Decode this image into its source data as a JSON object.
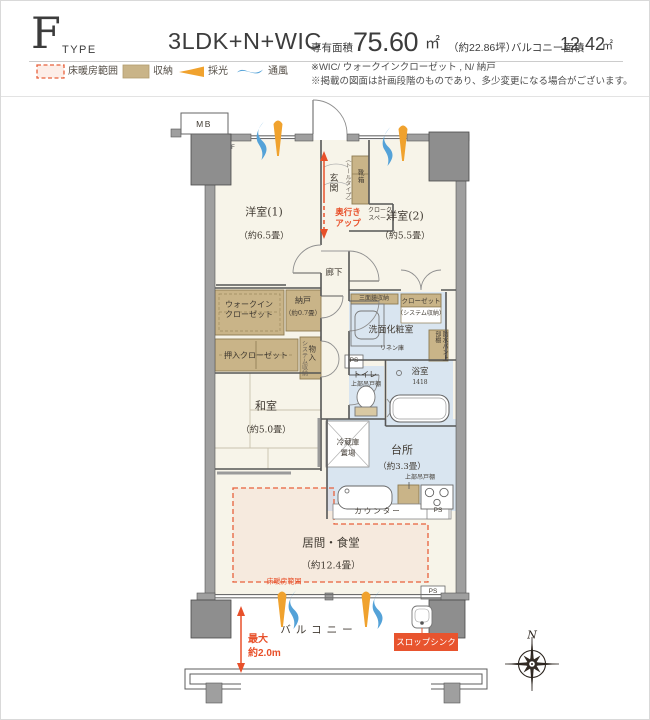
{
  "header": {
    "type_letter": "F",
    "type_word": "TYPE",
    "layout": "3LDK+N+WIC",
    "area_label": "専有面積",
    "area_value": "75.60",
    "area_unit": "㎡",
    "area_tsubo": "（約22.86坪）",
    "balcony_label": "バルコニー面積",
    "balcony_value": "12.42",
    "balcony_unit": "㎡"
  },
  "legend": {
    "floor_heating": "床暖房範囲",
    "storage": "収納",
    "daylight": "採光",
    "ventilation": "通風"
  },
  "notes": {
    "line1": "※WIC/ ウォークインクローゼット , N/ 納戸",
    "line2": "※掲載の図面は計画段階のものであり、多少変更になる場合がございます。"
  },
  "plan": {
    "mb": "MB",
    "f_mark": "F",
    "north": "N",
    "yoshitsu1": "洋室(1)",
    "yoshitsu1_size": "（約6.5畳）",
    "yoshitsu2": "洋室(2)",
    "yoshitsu2_size": "（約5.5畳）",
    "washitsu": "和室",
    "washitsu_size": "（約5.0畳）",
    "living": "居間・食堂",
    "living_size": "（約12.4畳）",
    "kitchen": "台所",
    "kitchen_size": "（約3.3畳）",
    "genkan": "玄関",
    "rouka": "廊下",
    "depth_line1": "奥行き",
    "depth_line2": "アップ",
    "cloak_line1": "クローク",
    "cloak_line2": "スペース",
    "shoe_box": "靴箱",
    "shoe_note": "（トールタイプ）",
    "wic_line1": "ウォークイン",
    "wic_line2": "クローゼット",
    "nando": "納戸",
    "nando_size": "（約0.7畳）",
    "oshiire": "押入クローゼット",
    "monoire": "物入",
    "monoire_note": "システム収納",
    "mirror_storage": "三面鏡収納",
    "closet": "クローゼット",
    "closet_note": "（システム収納）",
    "senmen": "洗面化粧室",
    "linen": "リネン庫",
    "waterproof_shelf": "防水パン上部棚",
    "toilet": "トイレ",
    "toilet_shelf": "上部吊戸棚",
    "bath": "浴室",
    "bath_size": "1418",
    "fridge_line1": "冷蔵庫",
    "fridge_line2": "置場",
    "hanging_shelf": "上部吊戸棚",
    "counter": "カウンター",
    "ps": "PS",
    "floor_heating_label": "床暖房範囲",
    "balcony": "バルコニー",
    "max_line1": "最大",
    "max_line2": "約2.0m",
    "slop_sink": "スロップシンク"
  },
  "colors": {
    "accent_red": "#e8502a",
    "storage_tan": "#c9b488",
    "wet_blue": "#d9e5f0",
    "room_cream": "#f7f4e9",
    "wall_gray": "#9f9f9f",
    "daylight_orange": "#f0a22e",
    "ventilation_blue": "#54a2d8",
    "slop_sink_bg": "#e8542e"
  }
}
